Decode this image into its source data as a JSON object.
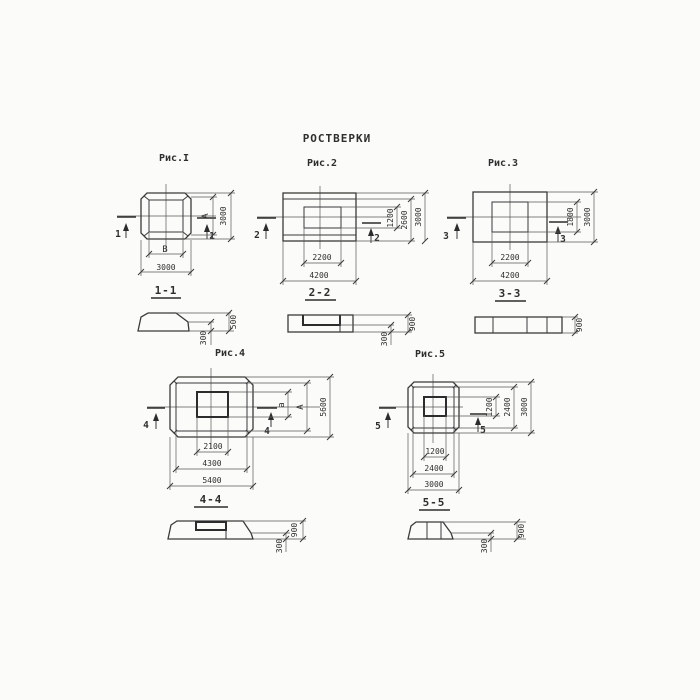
{
  "title": "РОСТВЕРКИ",
  "figures": {
    "fig1": {
      "label": "Рис.I",
      "cut_mark": "1",
      "section_label": "1-1",
      "dim_right_inner": "А",
      "dim_right_outer": "3000",
      "dim_bottom_inner": "В",
      "dim_bottom_outer": "3000",
      "section_dim_step": "300",
      "section_dim_total": "500"
    },
    "fig2": {
      "label": "Рис.2",
      "cut_mark": "2",
      "section_label": "2-2",
      "dim_right_inner": "1200",
      "dim_right_mid": "2600",
      "dim_right_outer": "3000",
      "dim_bottom_inner": "2200",
      "dim_bottom_outer": "4200",
      "section_dim_step": "300",
      "section_dim_total": "900"
    },
    "fig3": {
      "label": "Рис.3",
      "cut_mark": "3",
      "section_label": "3-3",
      "dim_right_inner": "1800",
      "dim_right_outer": "3000",
      "dim_bottom_inner": "2200",
      "dim_bottom_outer": "4200",
      "section_dim_total": "900"
    },
    "fig4": {
      "label": "Рис.4",
      "cut_mark": "4",
      "section_label": "4-4",
      "dim_right_inner": "а",
      "dim_right_mid": "А",
      "dim_right_outer": "5600",
      "dim_bottom_inner": "2100",
      "dim_bottom_mid": "4300",
      "dim_bottom_outer": "5400",
      "section_dim_step": "300",
      "section_dim_total": "900"
    },
    "fig5": {
      "label": "Рис.5",
      "cut_mark": "5",
      "section_label": "5-5",
      "dim_right_inner": "1200",
      "dim_right_mid": "2400",
      "dim_right_outer": "3000",
      "dim_bottom_inner": "1200",
      "dim_bottom_mid": "2400",
      "dim_bottom_outer": "3000",
      "section_dim_step": "300",
      "section_dim_total": "900"
    }
  },
  "colors": {
    "line_main": "#3a3a3a",
    "line_thin": "#5a5a5a",
    "background": "#fbfbf9"
  }
}
